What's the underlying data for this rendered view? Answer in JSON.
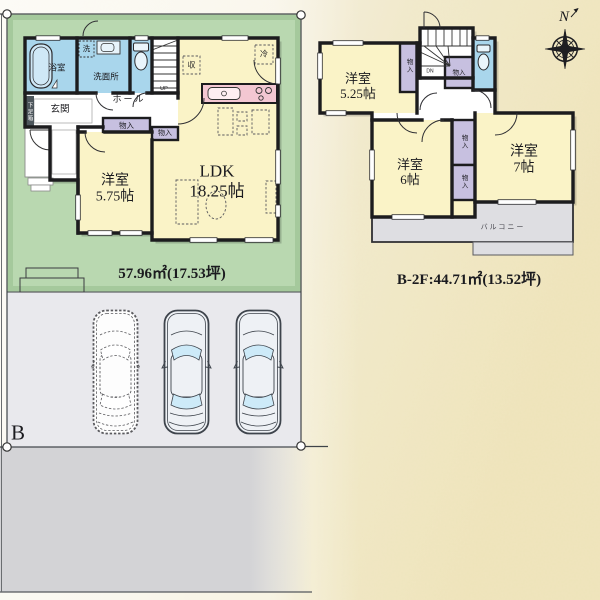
{
  "colors": {
    "lot_green": "#b9d8b0",
    "room_yellow": "#faf3c7",
    "water_blue": "#a9d6ec",
    "closet_purple": "#c7c0e0",
    "kitchen_pink": "#f3c7d2",
    "balcony_gray": "#dedee2",
    "parking_gray": "#e9e9ed",
    "road_gray": "#d3d3d6",
    "wall_black": "#1c1c1e",
    "paper_cream": "#f1e9cc"
  },
  "compass": {
    "north": "N"
  },
  "lot": {
    "label": "B"
  },
  "floor1": {
    "area_text": "57.96㎡(17.53坪)",
    "rooms": {
      "bath": "浴室",
      "laundry": "洗",
      "washroom": "洗面所",
      "entrance": "玄関",
      "hall": "ホール",
      "shoe_cabinet": "下足箱",
      "stairs": "UP",
      "storage": "収",
      "fridge": "冷",
      "closet_hall": "物入",
      "closet_hall2": "物入",
      "western": {
        "name": "洋室",
        "size": "5.75帖"
      },
      "ldk": {
        "name": "LDK",
        "size": "18.25帖"
      }
    }
  },
  "floor2": {
    "area_text": "B-2F:44.71㎡(13.52坪)",
    "rooms": {
      "western_a": {
        "name": "洋室",
        "size": "5.25帖"
      },
      "western_b": {
        "name": "洋室",
        "size": "6帖"
      },
      "western_c": {
        "name": "洋室",
        "size": "7帖"
      },
      "closet_1": "物入",
      "closet_2": "物入",
      "closet_3": "物入",
      "closet_4": "物入",
      "stairs": "DN",
      "balcony": "バルコニー"
    }
  }
}
